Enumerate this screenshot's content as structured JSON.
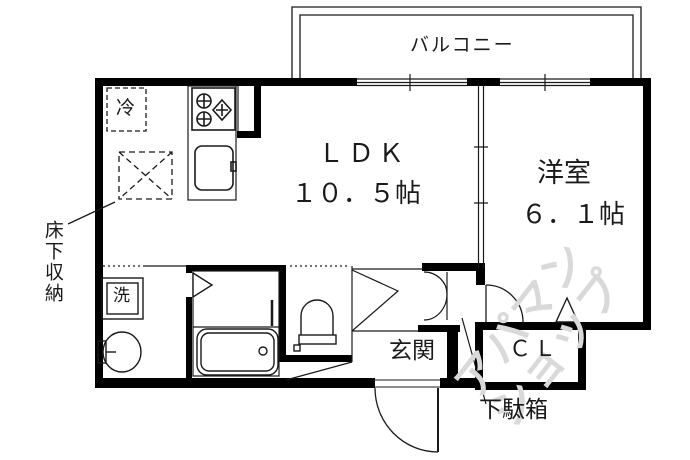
{
  "plan": {
    "balcony_label": "バルコニー",
    "ldk": {
      "name": "ＬＤＫ",
      "size": "１０．５帖"
    },
    "western_room": {
      "name": "洋室",
      "size": "６．１帖"
    },
    "entrance_label": "玄関",
    "closet_label": "ＣＬ",
    "shoe_cabinet_label": "下駄箱",
    "underfloor_storage_label": "床下収納",
    "refrigerator_label": "冷",
    "washer_label": "洗"
  },
  "watermark": {
    "line1": "アパマン",
    "line2": "ショップ",
    "color": "#d9d9d9"
  },
  "colors": {
    "line": "#000000",
    "background": "#ffffff"
  }
}
